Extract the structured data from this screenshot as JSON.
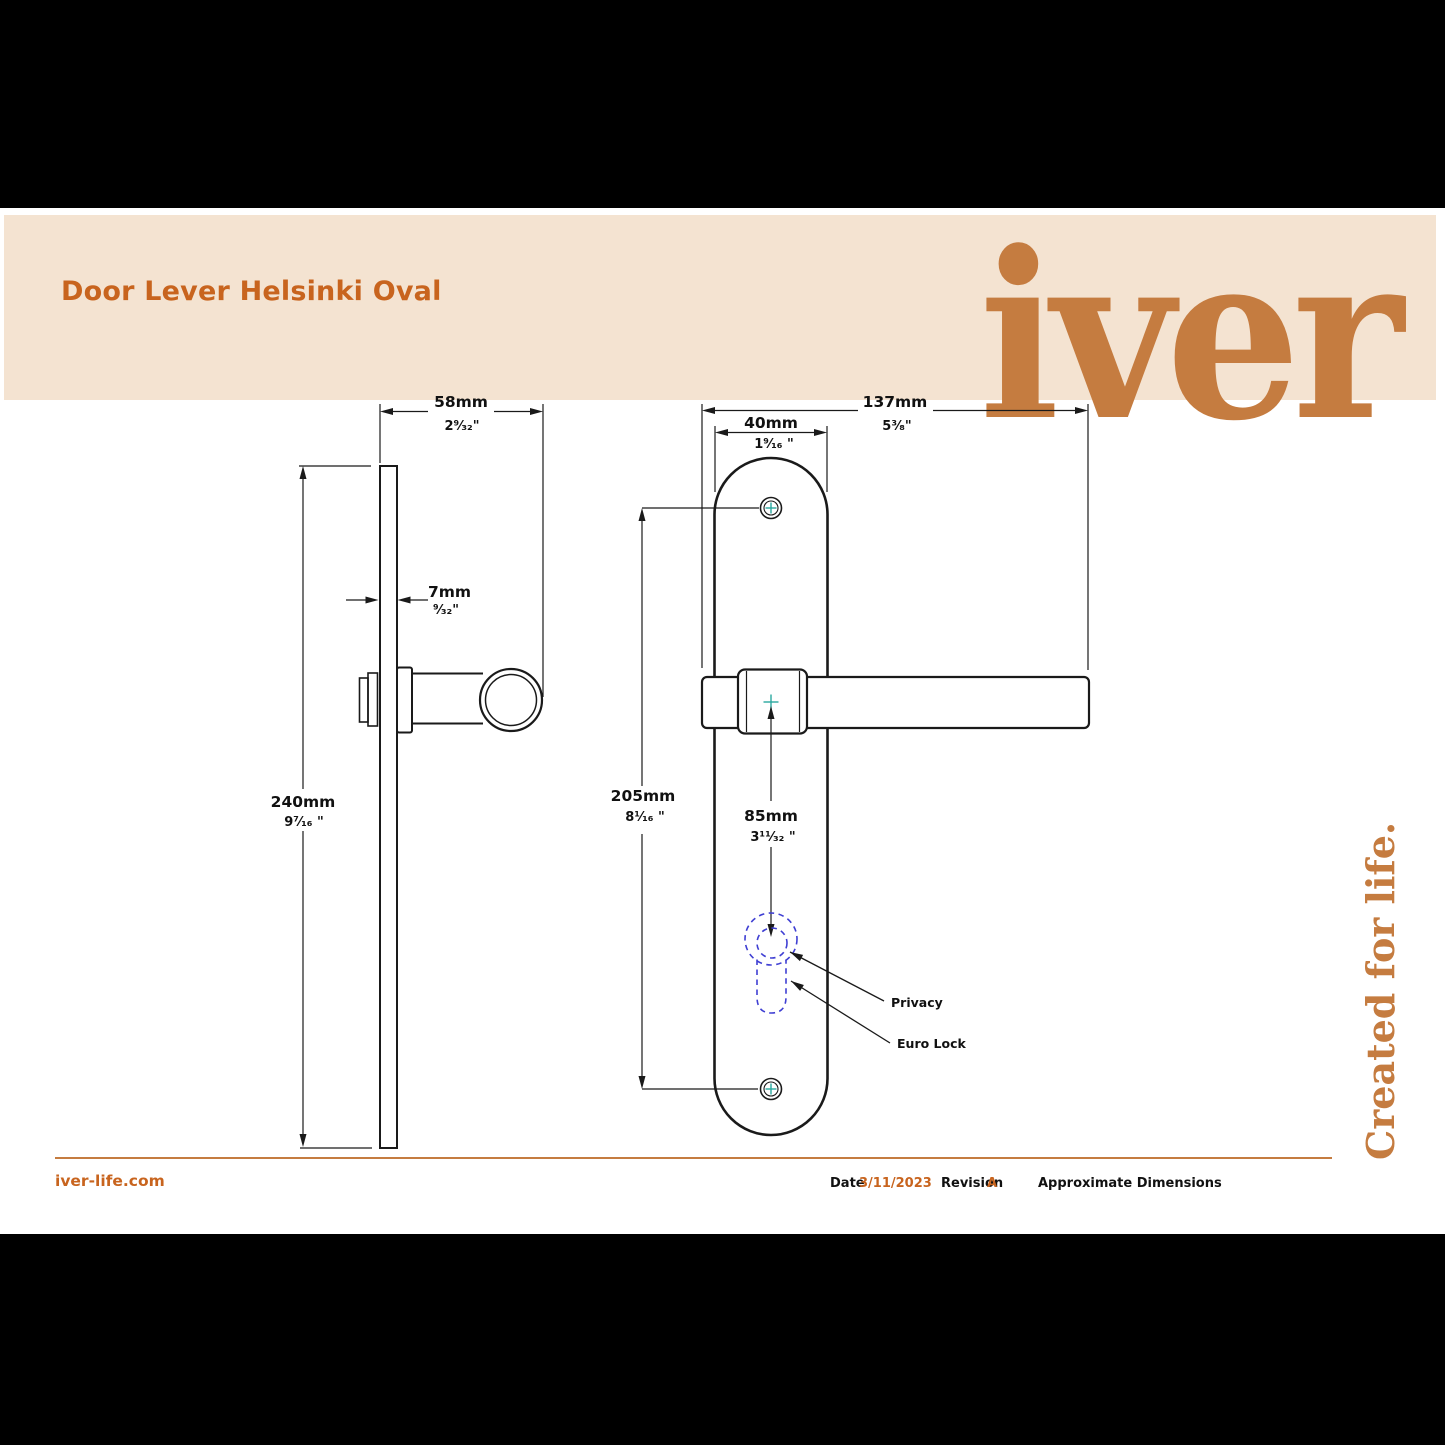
{
  "header": {
    "title": "Door Lever Helsinki Oval",
    "logo_text": "iver"
  },
  "side_tagline": "Created for life.",
  "footer": {
    "website": "iver-life.com",
    "date_label": "Date",
    "date_value": "3/11/2023",
    "revision_label": "Revision",
    "revision_value": "A",
    "note": "Approximate Dimensions"
  },
  "drawing": {
    "side_view": {
      "projection_mm": "58mm",
      "projection_in": "2⁹⁄₃₂\"",
      "thickness_mm": "7mm",
      "thickness_in": "⁹⁄₃₂\"",
      "height_mm": "240mm",
      "height_in": "9⁷⁄₁₆ \""
    },
    "front_view": {
      "length_mm": "137mm",
      "length_in": "5³⁄₈\"",
      "plate_width_mm": "40mm",
      "plate_width_in": "1⁹⁄₁₆ \"",
      "centres_mm": "205mm",
      "centres_in": "8¹⁄₁₆ \"",
      "lock_centre_mm": "85mm",
      "lock_centre_in": "3¹¹⁄₃₂ \"",
      "privacy_label": "Privacy",
      "euro_label": "Euro Lock"
    }
  },
  "colors": {
    "accent_orange": "#C8641E",
    "logo_orange": "#C57C40",
    "band_cream": "#F4E3D1",
    "keyhole_blue": "#3F3FD3",
    "centre_teal": "#2AA9A0",
    "line_black": "#1A1A1A"
  }
}
